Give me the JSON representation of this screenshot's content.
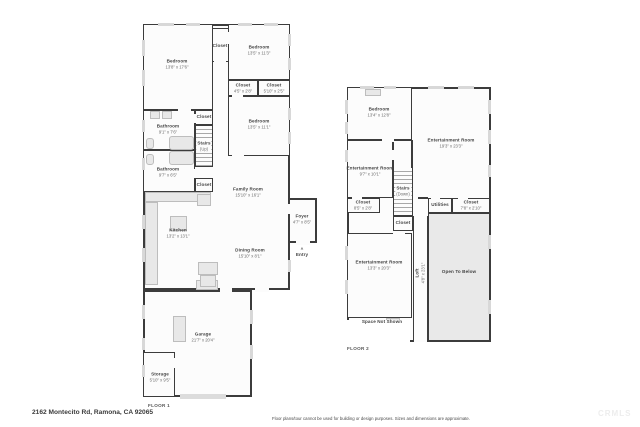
{
  "meta": {
    "address": "2162 Montecito Rd, Ramona, CA 92065",
    "disclaimer": "Floor plans/tour cannot be used for building or design purposes. Sizes and dimensions are approximate.",
    "watermark": "CRMLS"
  },
  "colors": {
    "wall": "#3c3c3c",
    "room_fill": "#fcfcfc",
    "open_below_fill": "#e9e9e9",
    "fixture_fill": "#e8e8e8",
    "window_marker": "#d8d8d8"
  },
  "floor1": {
    "label": "FLOOR 1",
    "rooms": {
      "bed1": {
        "name": "Bedroom",
        "dims": "13'8\" x 17'6\""
      },
      "closet_top": {
        "name": "Closet"
      },
      "bed2": {
        "name": "Bedroom",
        "dims": "13'5\" x 11'3\""
      },
      "closet_a": {
        "name": "Closet",
        "dims": "4'5\" x 2'8\""
      },
      "closet_b": {
        "name": "Closet",
        "dims": "5'10\" x 2'5\""
      },
      "bed3": {
        "name": "Bedroom",
        "dims": "13'5\" x 11'1\""
      },
      "bath1": {
        "name": "Bathroom",
        "dims": "9'1\" x 7'6\""
      },
      "closet_stairs_top": {
        "name": "Closet"
      },
      "stairs": {
        "name": "Stairs",
        "dims": "(Up)"
      },
      "bath2": {
        "name": "Bathroom",
        "dims": "9'7\" x 6'5\""
      },
      "closet_stairs_bottom": {
        "name": "Closet"
      },
      "family": {
        "name": "Family Room",
        "dims": "15'10\" x 16'1\""
      },
      "kitchen": {
        "name": "Kitchen",
        "dims": "13'2\" x 13'1\""
      },
      "dining": {
        "name": "Dining Room",
        "dims": "15'10\" x 8'1\""
      },
      "foyer": {
        "name": "Foyer",
        "dims": "4'7\" x 8'5\""
      },
      "entry": {
        "name": "Entry"
      },
      "garage": {
        "name": "Garage",
        "dims": "21'7\" x 20'4\""
      },
      "storage": {
        "name": "Storage",
        "dims": "5'10\" x 9'5\""
      }
    }
  },
  "floor2": {
    "label": "FLOOR 2",
    "rooms": {
      "bed": {
        "name": "Bedroom",
        "dims": "13'4\" x 12'8\""
      },
      "ent_big": {
        "name": "Entertainment Room",
        "dims": "19'3\" x 23'3\""
      },
      "ent_small": {
        "name": "Entertainment Room",
        "dims": "9'7\" x 10'1\""
      },
      "stairs": {
        "name": "Stairs",
        "dims": "(Down)"
      },
      "closet_left": {
        "name": "Closet",
        "dims": "8'5\" x 2'8\""
      },
      "closet_stairs": {
        "name": "Closet"
      },
      "utilities": {
        "name": "Utilities"
      },
      "closet_right": {
        "name": "Closet",
        "dims": "7'8\" x 2'10\""
      },
      "ent_bottom": {
        "name": "Entertainment Room",
        "dims": "13'3\" x 20'3\""
      },
      "loft": {
        "name": "Loft",
        "dims": "4'8\" x 23'1\""
      },
      "open_below": {
        "name": "Open To Below"
      },
      "space_not_shown": {
        "name": "Space Not Shown"
      }
    }
  }
}
